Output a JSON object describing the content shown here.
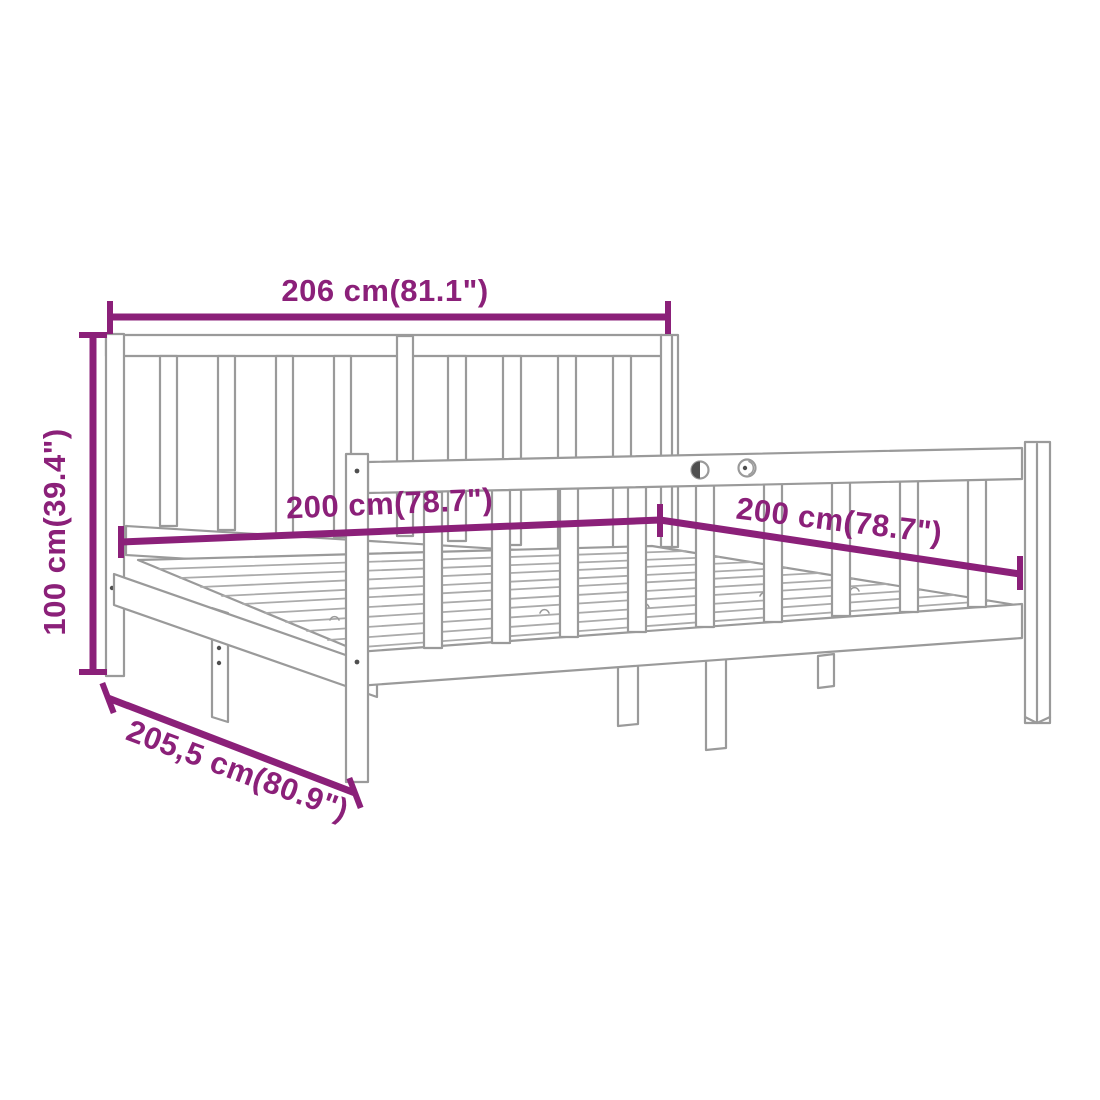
{
  "diagram": {
    "kind": "furniture-dimension-diagram",
    "subject": "Wooden bed frame with slatted headboard, side guard rail and slatted base",
    "style": {
      "dimension_color": "#8B2079",
      "artwork_line_color": "#9A9A9A",
      "background_color": "#ffffff"
    },
    "dimensions": {
      "overall_width": {
        "label": "206 cm(81.1\")",
        "cm": "206",
        "inches": "81.1",
        "position": "top"
      },
      "overall_height": {
        "label": "100 cm(39.4\")",
        "cm": "100",
        "inches": "39.4",
        "position": "left"
      },
      "mattress_width": {
        "label": "200 cm(78.7\")",
        "cm": "200",
        "inches": "78.7",
        "position": "center"
      },
      "mattress_length": {
        "label": "200 cm(78.7\")",
        "cm": "200",
        "inches": "78.7",
        "position": "right"
      },
      "overall_depth": {
        "label": "205,5 cm(80.9\")",
        "cm": "205,5",
        "inches": "80.9",
        "position": "bottom-left"
      }
    }
  }
}
